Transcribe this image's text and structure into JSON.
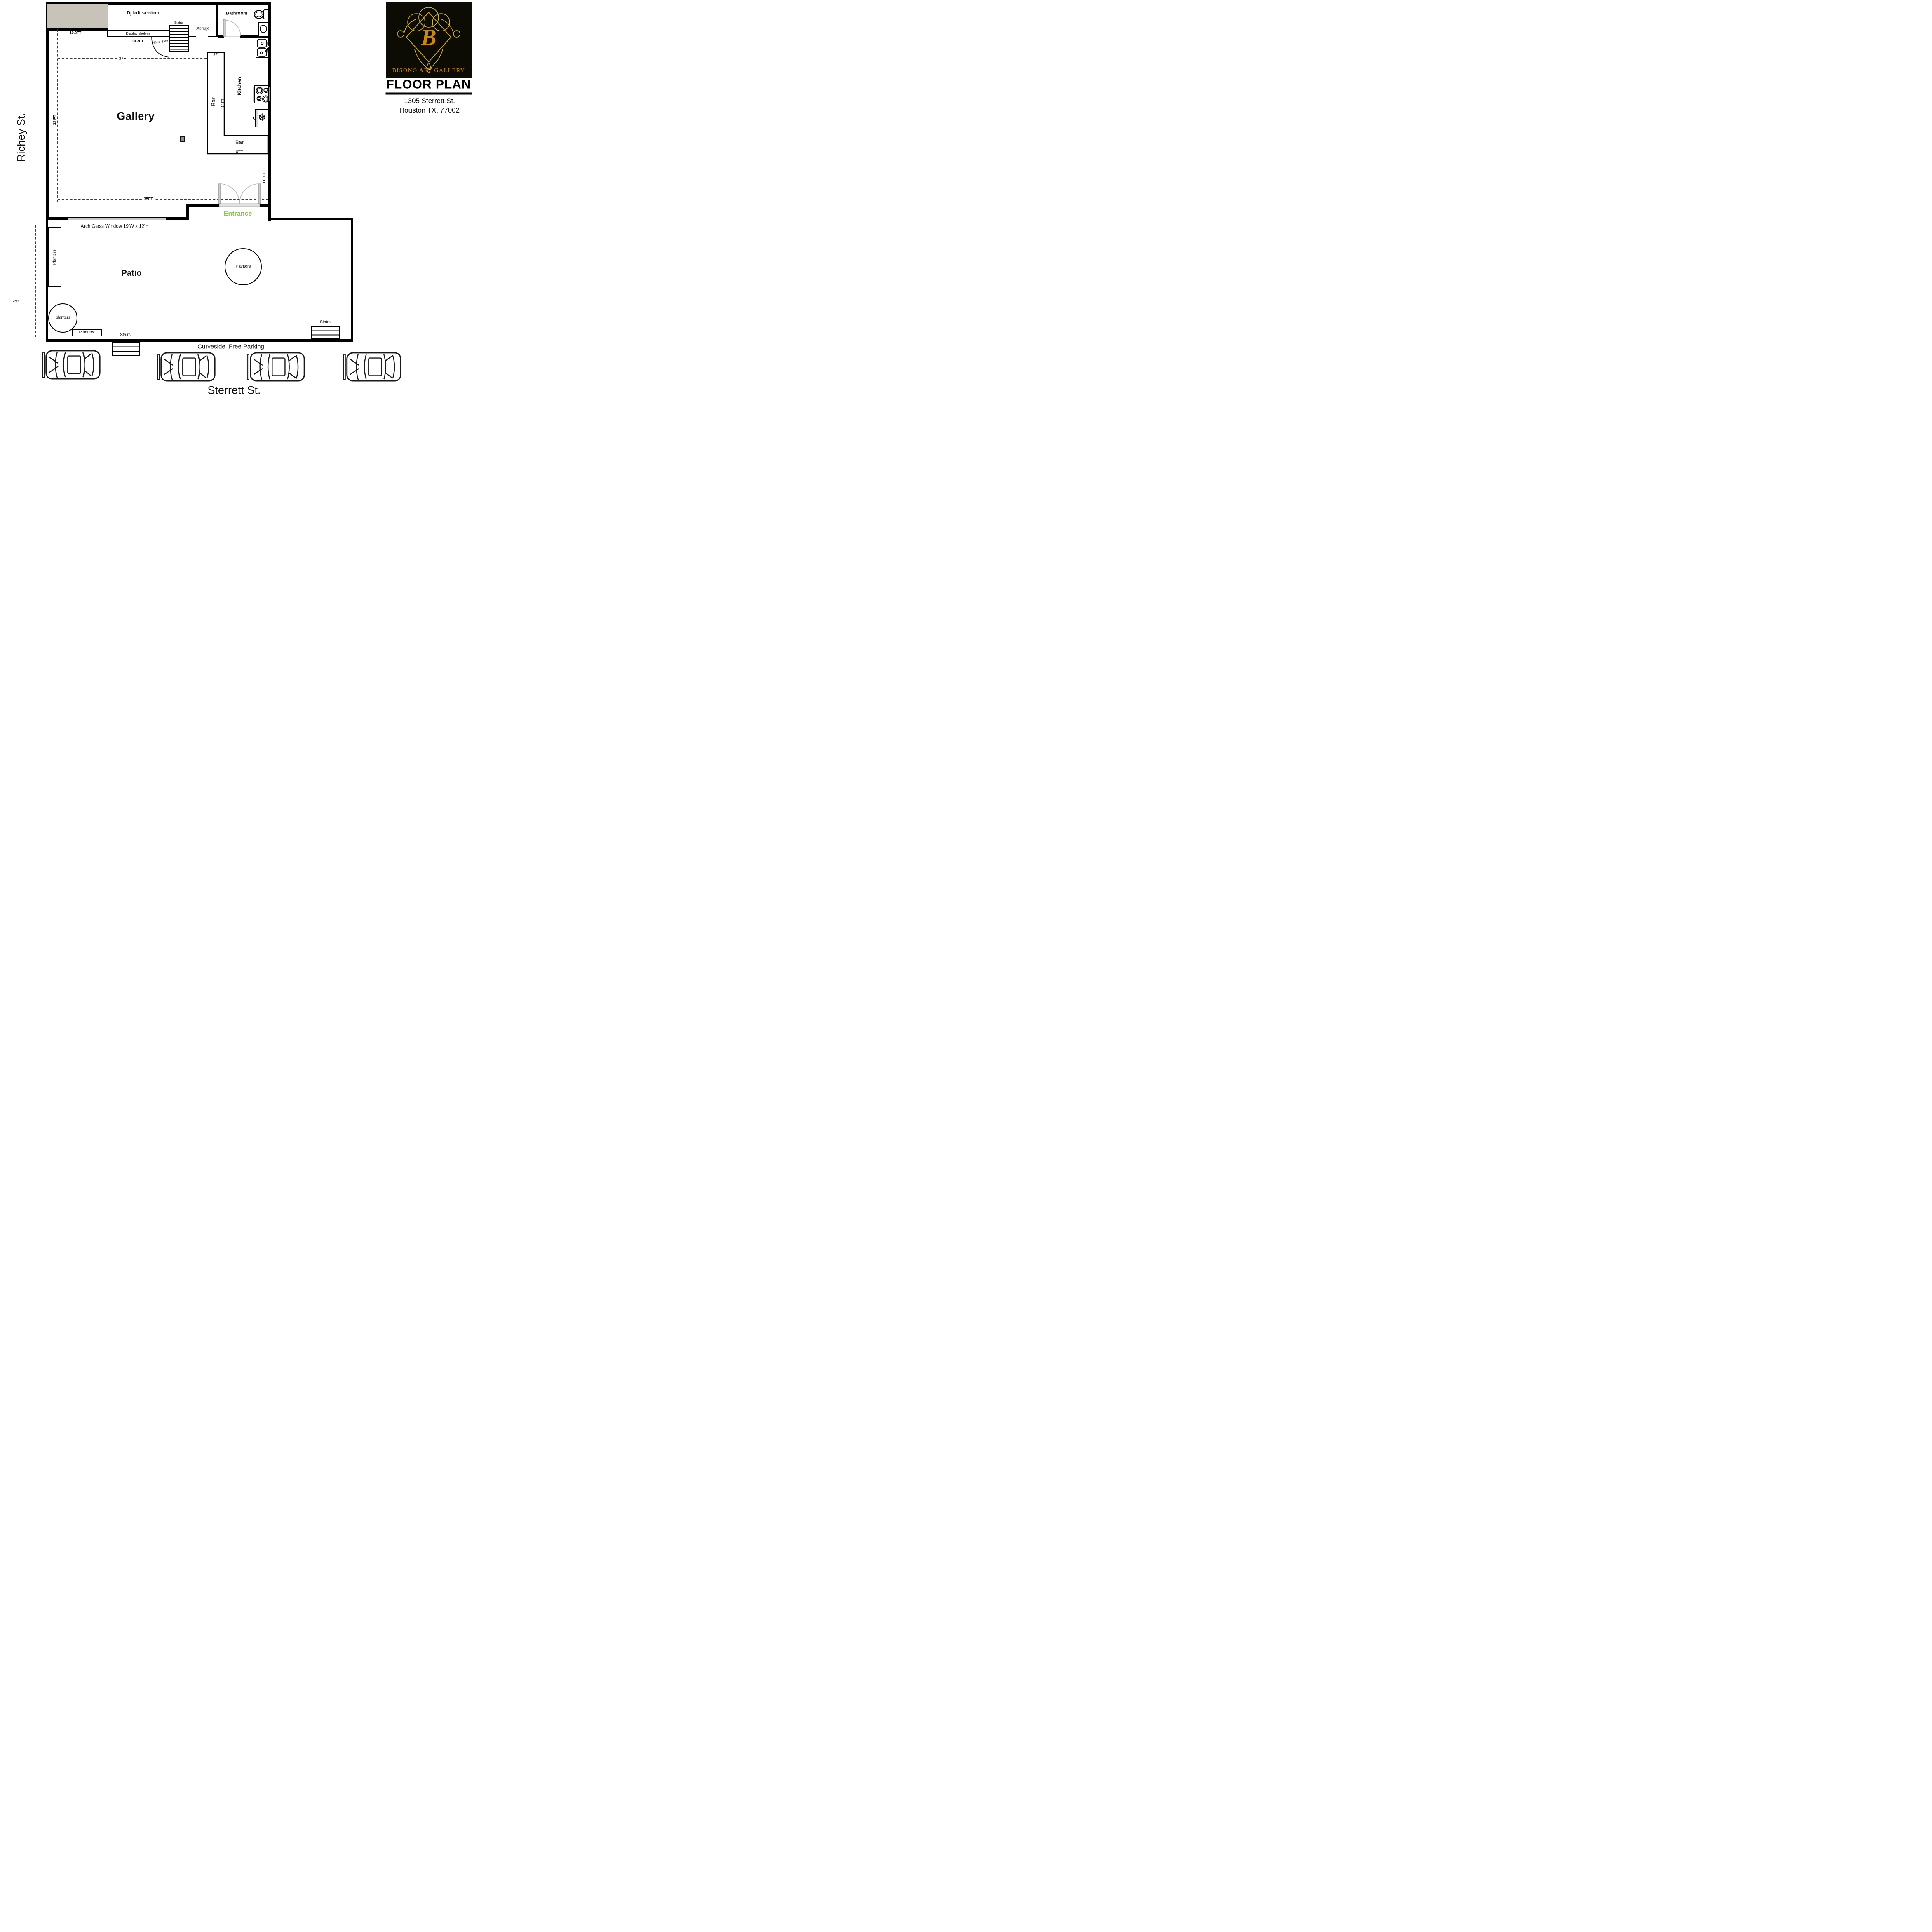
{
  "streets": {
    "left_street": "Richey St.",
    "bottom_street": "Sterrett St."
  },
  "title_block": {
    "monogram": "B",
    "gallery_name": "BISONG ART GALLERY",
    "heading": "FLOOR PLAN",
    "address1": "1305 Sterrett St.",
    "address2": "Houston TX. 77002",
    "bg_color": "#0c0c05",
    "gold_color": "#c8861b"
  },
  "rooms": {
    "dj_loft": "Dj loft section",
    "gallery": "Gallery",
    "kitchen": "Kitchen",
    "bathroom": "Bathroom",
    "storage": "Storage",
    "patio": "Patio",
    "entrance": "Entrance",
    "bar_front": "Bar",
    "bar_back": "Bar"
  },
  "features": {
    "display_shelves": "Display shelves",
    "elev_step": "Elev. Step",
    "stairs_loft": "Stairs",
    "stairs_patio_left": "Stairs",
    "stairs_patio_right": "Stairs",
    "planters_wall": "Planters",
    "planters_patio": "Planters",
    "planters_corner": "planters",
    "planters_box": "Planters",
    "arch_window": "Arch Glass Window 19'W x 12'H",
    "parking_note": "Curveside  Free Parking"
  },
  "dimensions": {
    "loft_width": "10.2FT",
    "shelf_width": "10.3FT",
    "gallery_top_width": "27FT",
    "gallery_left_height": "32 FT",
    "gallery_bottom_width": "35FT",
    "bar_width_in": "27\"",
    "bar_length": "14'FT",
    "bar_back_length": "8'FT",
    "entrance_wall": "11.9FT",
    "patio_left": "25ft"
  },
  "icons": {
    "freezer": "❄"
  },
  "accents": {
    "entrance_green": "#8dc63f"
  }
}
